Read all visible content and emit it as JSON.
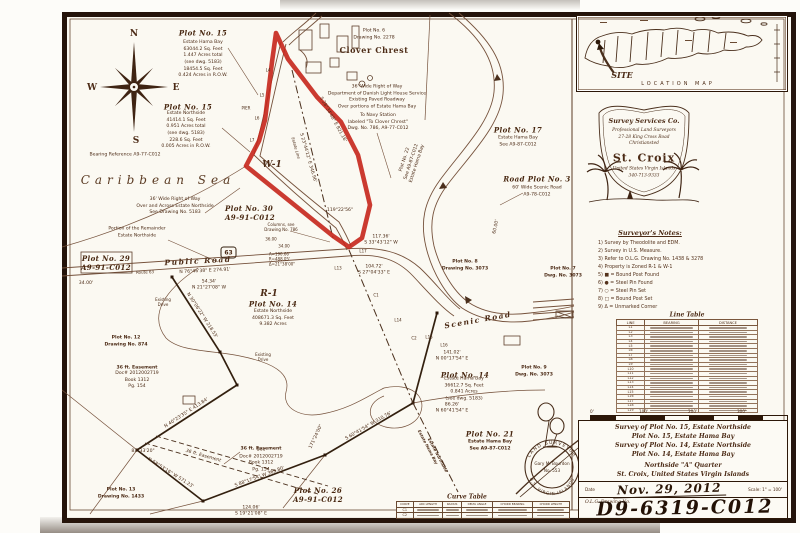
{
  "colors": {
    "ink": "#5b3a24",
    "dark": "#2c1708",
    "red": "#c5251b",
    "paper": "#fbf9f2"
  },
  "map": {
    "compass": {
      "n": "N",
      "e": "E",
      "s": "S",
      "w": "W"
    },
    "sea": "Caribbean Sea",
    "pier": "PIER",
    "w1": "W-1",
    "plot15_hama": {
      "title": "Plot No. 15",
      "body": "Estate Hama Bay\n63044.2 Sq. Feet\n1.447 Acres total\n(see dwg. 5183)\n18454.5 Sq. Feet\n0.424 Acres in R.O.W."
    },
    "plot15_north": {
      "title": "Plot No. 15",
      "body": "Estate Northside\n41414.1 Sq. Feet\n0.951 Acres total\n(see dwg. 5183)\n228.6 Sq. Feet\n0.005 Acres in R.O.W."
    },
    "bearing_reference": "Bearing Reference A9-77-C012",
    "clover": {
      "plot": "Plot No. 6\nDrawing No. 2278",
      "name": "Clover Chrest"
    },
    "row_danish": "36' Wide Right of Way\nDepartment of Danish Light House Service\nExisting Paved Roadway\nOver portions of Estate Hama Bay",
    "to_navy": "To Navy Station\nlabeled \"To Clover Chrest\"\nDwg. No. 786, A9-77-C012",
    "plot17": {
      "title": "Plot No. 17",
      "body": "Estate Hama Bay\nSee A9-87-C012"
    },
    "plot22": "Plot No. 22\nSee A9-87-C012\nEstate Hama Bay",
    "road_plot3": {
      "title": "Road Plot No. 3",
      "body": "60' Wide Scenic Road\nA9-78-C012"
    },
    "row_northside": "36' Wide Right of Way\nOver and Across Estate Northside\nSee Drawing No. 5183",
    "plot30": "Plot No. 30\nA9-91-C012",
    "remainder": "Portion of the Remainder\nEstate Northside",
    "plot29": "Plot No. 29\nA9-91-C012",
    "public_road": "Public Road",
    "route_shield": "63",
    "route_63": "Route 63",
    "meas_3400": "34.00'",
    "meas_3400b": "34.00",
    "meas_3600": "36.00",
    "bearing_public": "N 76°46'38\" E  274.91'",
    "curve_arc": "A=190.66'\nR=488.05'\nΔ=21°38'00\"",
    "meas_5434": "54.34'\nN 21°27'08\" W",
    "r1_zone": "R-1",
    "plot14_r1": {
      "title": "Plot No. 14",
      "body": "Estate Northside\n408671.3 Sq. Feet\n9.382 Acres"
    },
    "existing_drive": "Existing\nDrive",
    "plot12": "Plot No. 12\nDrawing No. 874",
    "easement1": {
      "title": "36 ft. Easement",
      "body": "Doc# 2012002719\nBook 1312\nPg. 154"
    },
    "bearing_4023": "N 40°23'35\" E  413.84'",
    "angle_8333": "83°33'20\"",
    "easement_line": "36 ft. Easement",
    "easement2": {
      "title": "36 ft. Easement",
      "body": "See\nDoc# 2012002719\nBook 1312\nPg. 154"
    },
    "bearing_5853": "N 58°53'16\" W  571.23'",
    "bearing_8817": "S 88°17'54\" W  369.80'",
    "plot13": "Plot No. 13\nDrawing No. 1433",
    "meas_12406": "124.06'\nS 19°21'08\" E",
    "plot26": "Plot No. 26\nA9-91-C012",
    "bearing_6041": "S 60°41'54\" W  310.76'",
    "angle_17124": "171°24'00\"",
    "meas_8626": "86.26'\nN 60°41'54\" E",
    "estate_hama": "Estate Hama Bay",
    "estate_north": "Estate Northside",
    "plot21": {
      "title": "Plot No. 21",
      "body": "Estate Hama Bay\nSee A9-87-C012"
    },
    "plot14_hama": {
      "title": "Plot No. 14",
      "body": "Estate Hama Bay\n36612.7 Sq. Feet\n0.841 Acres\n(see dwg. 5183)"
    },
    "meas_14102": "141.02'\nN 00°17'54\" E",
    "plot9": "Plot No. 9\nDwg. No. 3073",
    "plot8": "Plot No. 8\nDrawing No. 3073",
    "plot7": "Plot No. 7\nDwg. No. 3073",
    "scenic_road": "Scenic Road",
    "meas_6000": "60.00'",
    "meas_11736": "117.36'\nS 33°43'12\" W",
    "meas_10472": "104.72'\nS 27°04'33\" E",
    "estate_line_label": "Estate Line",
    "bearing_2344": "S 23°44'12\" E  346.96'",
    "bearing_2834": "S 28°34'48\" E  821.16'",
    "bearing_3006": "N 30°06'22\" W  218.53'",
    "angle_11922": "119°22'56\"",
    "columns_note": "Columns, see\nDrawing No. 786",
    "marks": {
      "l4": "L4",
      "l5": "L5",
      "l6": "L6",
      "l7": "L7",
      "l13": "L13",
      "l17": "L17",
      "c1": "C1",
      "l14": "L14",
      "l15": "L15",
      "l16": "L16",
      "c2": "C2"
    }
  },
  "sidebar": {
    "location_map": {
      "site": "SITE",
      "caption": "LOCATION MAP"
    },
    "logo": {
      "company": "Survey Services Co.",
      "address": "Professional Land Surveyors\n27-28 King Cross Road\nChristiansted",
      "island": "St. Croix",
      "footer": "United States Virgin Islands\n340-713-9333"
    },
    "notes": {
      "title": "Surveyor's Notes:",
      "items": [
        "1) Survey by Theodolite and EDM.",
        "2) Survey in U.S. Measure.",
        "3) Refer to O.L.G. Drawing No. 1438 & 3278",
        "4) Property is Zoned R-1 & W-1",
        "5) ■ = Bound Post Found",
        "6) ● = Steel Pin Found",
        "7) ○ = Steel Pin Set",
        "8) □ = Bound Post Set",
        "9) Δ = Unmarked Corner"
      ]
    },
    "line_table": {
      "title": "Line Table",
      "headers": [
        "LINE",
        "BEARING",
        "DISTANCE"
      ],
      "rows": [
        "L1",
        "L2",
        "L3",
        "L4",
        "L5",
        "L6",
        "L7",
        "L8",
        "L9",
        "L10",
        "L11",
        "L12",
        "L13",
        "L14",
        "L15",
        "L16",
        "L17",
        "L18",
        "L19"
      ]
    },
    "scale_bar": {
      "labels": [
        "0'",
        "100'",
        "200'",
        "300'"
      ]
    },
    "title_block": {
      "lines": "Survey of Plot No. 15, Estate Northside\nPlot No. 15, Estate Hama Bay\nSurvey of Plot No. 14, Estate Northside\nPlot No. 14, Estate Hama Bay",
      "quarter": "Northside \"A\" Quarter",
      "location": "St. Croix, United States Virgin Islands",
      "date_label": "Date",
      "date_value": "Nov. 29, 2012",
      "scale_label": "Scale: 1\" = 100'",
      "olg_label": "O.L.G. Drawing No.",
      "drawing_no": "D9-6319-C012"
    }
  },
  "curve_table": {
    "title": "Curve Table",
    "headers": [
      "CURVE",
      "ARC LENGTH",
      "RADIUS",
      "DELTA ANGLE",
      "CHORD BEARING",
      "CHORD LENGTH"
    ],
    "rows": [
      "C1",
      "C2"
    ]
  },
  "seal": {
    "arc_top": "LAND SURVEYOR",
    "arc_bottom": "U.S. VIRGIN ISLANDS",
    "name": "Gary M. Bourdon",
    "number": "No. 553"
  }
}
